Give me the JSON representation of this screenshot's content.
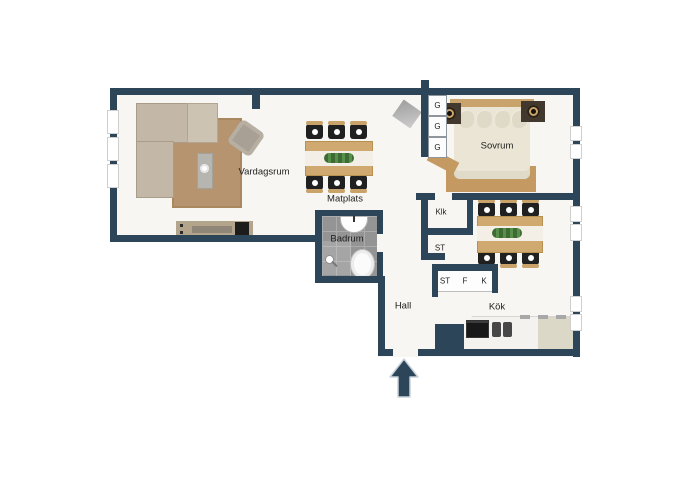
{
  "title": "Apartment floor plan",
  "rooms": {
    "vardagsrum": "Vardagsrum",
    "matplats": "Matplats",
    "badrum": "Badrum",
    "sovrum": "Sovrum",
    "klk": "Klk",
    "st_room": "ST",
    "hall": "Hall",
    "kok": "Kök"
  },
  "closets": {
    "g_cells": [
      "G",
      "G",
      "G"
    ],
    "st": "ST",
    "f": "F",
    "k": "K"
  },
  "icons": {
    "entrance_arrow": "up-arrow"
  },
  "colors": {
    "wall": "#2c4558",
    "floor": "#f7f6f2",
    "background": "#ffffff",
    "bathroom_tile": "#949494",
    "living_rug": "#b5946f",
    "bedroom_rug": "#c49a62",
    "sofa": "#c3b8a7",
    "wood": "#cfa96f",
    "chair_seat": "#202020",
    "bed": "#eae5d5",
    "counter": "#f3f2ee",
    "counter_right": "#dcd8c7",
    "arrow": "#2c4558"
  },
  "furniture": [
    "corner-sofa",
    "living-rug",
    "coffee-table",
    "armchair",
    "tv-bench",
    "dining-table-six-chairs",
    "wardrobes",
    "double-bed",
    "nightstand-lamps",
    "kitchen-table-six-chairs",
    "kitchen-counter",
    "stove",
    "sink",
    "bathtub",
    "shower"
  ]
}
